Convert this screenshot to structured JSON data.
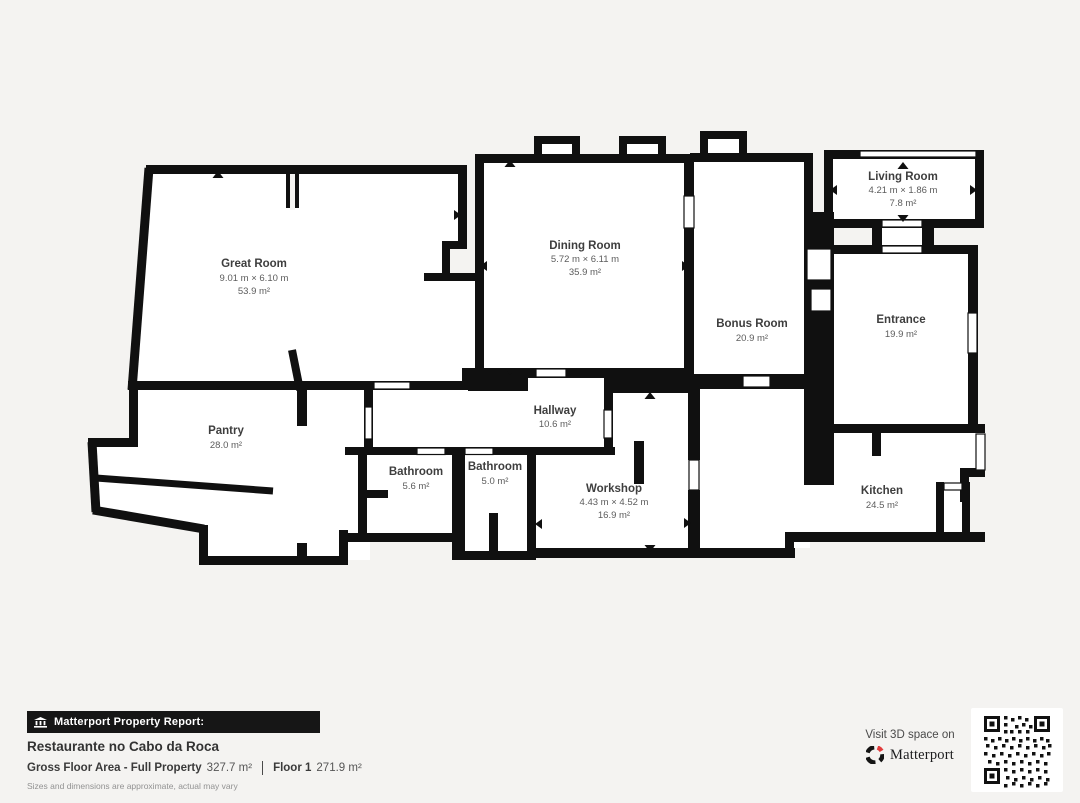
{
  "plan": {
    "rooms": [
      {
        "name": "Great Room",
        "dims": "9.01 m × 6.10 m",
        "area": "53.9 m²"
      },
      {
        "name": "Dining Room",
        "dims": "5.72 m × 6.11 m",
        "area": "35.9 m²"
      },
      {
        "name": "Living Room",
        "dims": "4.21 m × 1.86 m",
        "area": "7.8 m²"
      },
      {
        "name": "Bonus Room",
        "area": "20.9 m²"
      },
      {
        "name": "Entrance",
        "area": "19.9 m²"
      },
      {
        "name": "Pantry",
        "area": "28.0 m²"
      },
      {
        "name": "Hallway",
        "area": "10.6 m²"
      },
      {
        "name": "Bathroom",
        "area": "5.6 m²"
      },
      {
        "name": "Bathroom",
        "area": "5.0 m²"
      },
      {
        "name": "Workshop",
        "dims": "4.43 m × 4.52 m",
        "area": "16.9 m²"
      },
      {
        "name": "Kitchen",
        "area": "24.5 m²"
      }
    ]
  },
  "report": {
    "badge": "Matterport Property Report:",
    "property_name": "Restaurante no Cabo da Roca",
    "gross_label": "Gross Floor Area - Full Property",
    "gross_value": "327.7 m²",
    "floor_label": "Floor 1",
    "floor_value": "271.9 m²",
    "disclaimer": "Sizes and dimensions are approximate, actual may vary"
  },
  "cta": {
    "visit_text": "Visit 3D space on",
    "brand": "Matterport"
  },
  "colors": {
    "wall": "#101010",
    "background": "#f4f3f1",
    "brand_red": "#e13c3c"
  }
}
